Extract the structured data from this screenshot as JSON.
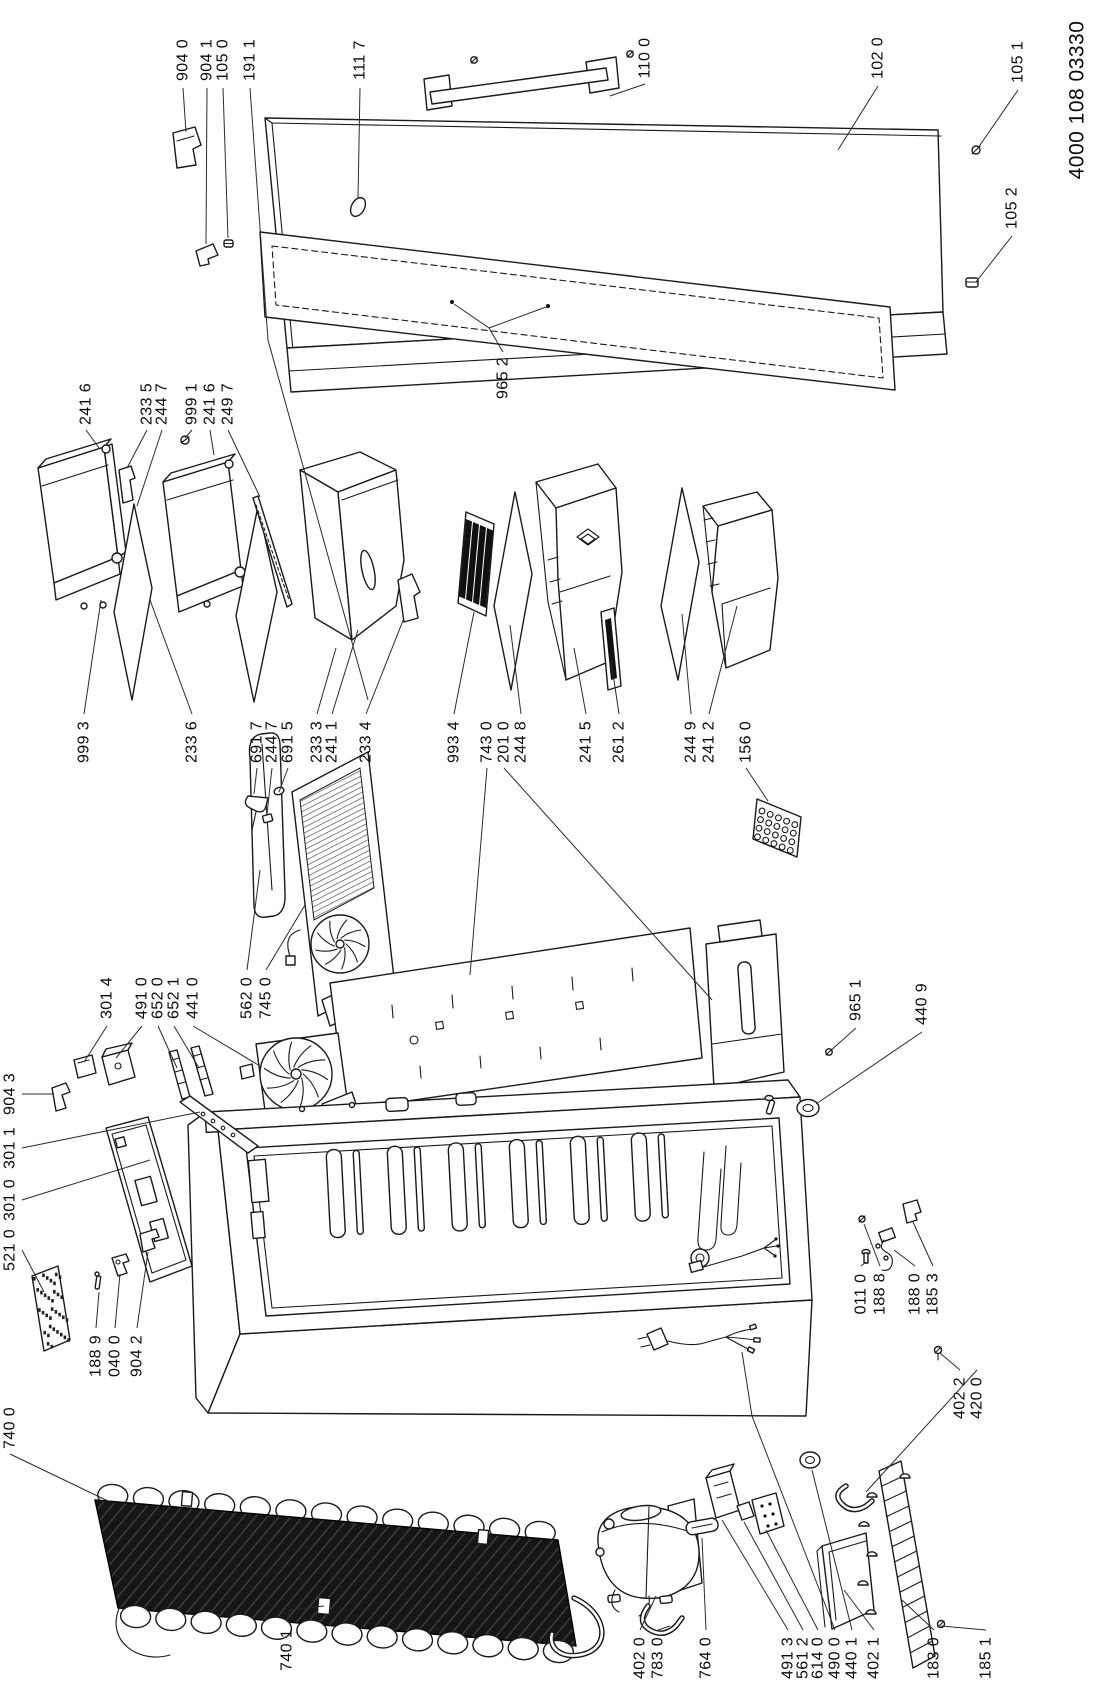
{
  "document": {
    "number": "4000 108 03330"
  },
  "parts": [
    {
      "label": "904 0",
      "pos": [
        183,
        60
      ],
      "leaders": [
        [
          [
            183,
            88
          ],
          [
            186,
            132
          ]
        ]
      ]
    },
    {
      "label": "904 1",
      "pos": [
        207,
        60
      ],
      "leaders": [
        [
          [
            207,
            88
          ],
          [
            206,
            244
          ]
        ]
      ]
    },
    {
      "label": "105 0",
      "pos": [
        223,
        60
      ],
      "leaders": [
        [
          [
            223,
            88
          ],
          [
            228,
            238
          ]
        ]
      ]
    },
    {
      "label": "191 1",
      "pos": [
        250,
        60
      ],
      "leaders": [
        [
          [
            250,
            88
          ],
          [
            268,
            340
          ],
          [
            368,
            700
          ]
        ]
      ]
    },
    {
      "label": "111 7",
      "pos": [
        360,
        60
      ],
      "leaders": [
        [
          [
            360,
            88
          ],
          [
            358,
            198
          ]
        ]
      ]
    },
    {
      "label": "110 0",
      "pos": [
        645,
        58
      ],
      "leaders": [
        [
          [
            645,
            84
          ],
          [
            610,
            96
          ]
        ]
      ]
    },
    {
      "label": "102 0",
      "pos": [
        878,
        58
      ],
      "leaders": [
        [
          [
            878,
            86
          ],
          [
            838,
            150
          ]
        ]
      ]
    },
    {
      "label": "105 1",
      "pos": [
        1018,
        62
      ],
      "leaders": [
        [
          [
            1018,
            90
          ],
          [
            978,
            148
          ]
        ]
      ]
    },
    {
      "label": "105 2",
      "pos": [
        1012,
        208
      ],
      "leaders": [
        [
          [
            1012,
            236
          ],
          [
            976,
            282
          ]
        ]
      ]
    },
    {
      "label": "965 2",
      "pos": [
        503,
        378
      ],
      "leaders": [
        [
          [
            503,
            352
          ],
          [
            489,
            328
          ],
          [
            454,
            304
          ]
        ],
        [
          [
            489,
            328
          ],
          [
            546,
            307
          ]
        ]
      ]
    },
    {
      "label": "241 6",
      "pos": [
        86,
        404
      ],
      "leaders": [
        [
          [
            86,
            430
          ],
          [
            99,
            448
          ]
        ]
      ]
    },
    {
      "label": "233 5",
      "pos": [
        147,
        404
      ],
      "leaders": [
        [
          [
            147,
            430
          ],
          [
            127,
            468
          ]
        ]
      ]
    },
    {
      "label": "244 7",
      "pos": [
        162,
        404
      ],
      "leaders": [
        [
          [
            162,
            430
          ],
          [
            137,
            506
          ]
        ]
      ]
    },
    {
      "label": "999 1",
      "pos": [
        192,
        404
      ],
      "leaders": [
        [
          [
            192,
            430
          ],
          [
            185,
            438
          ]
        ]
      ]
    },
    {
      "label": "241 6",
      "pos": [
        210,
        404
      ],
      "leaders": [
        [
          [
            210,
            430
          ],
          [
            214,
            455
          ]
        ]
      ]
    },
    {
      "label": "249 7",
      "pos": [
        228,
        404
      ],
      "leaders": [
        [
          [
            228,
            430
          ],
          [
            260,
            497
          ]
        ]
      ]
    },
    {
      "label": "999 3",
      "pos": [
        84,
        742
      ],
      "leaders": [
        [
          [
            84,
            714
          ],
          [
            101,
            600
          ]
        ]
      ]
    },
    {
      "label": "233 6",
      "pos": [
        192,
        742
      ],
      "leaders": [
        [
          [
            192,
            714
          ],
          [
            150,
            600
          ]
        ]
      ]
    },
    {
      "label": "691 7",
      "pos": [
        257,
        742
      ],
      "leaders": [
        [
          [
            257,
            768
          ],
          [
            254,
            794
          ]
        ]
      ]
    },
    {
      "label": "244 7",
      "pos": [
        272,
        742
      ],
      "leaders": [
        [
          [
            272,
            768
          ],
          [
            267,
            814
          ]
        ]
      ]
    },
    {
      "label": "691 5",
      "pos": [
        288,
        742
      ],
      "leaders": [
        [
          [
            288,
            768
          ],
          [
            279,
            792
          ]
        ]
      ]
    },
    {
      "label": "233 3",
      "pos": [
        317,
        742
      ],
      "leaders": [
        [
          [
            317,
            714
          ],
          [
            336,
            648
          ]
        ]
      ]
    },
    {
      "label": "241 1",
      "pos": [
        332,
        742
      ],
      "leaders": [
        [
          [
            332,
            714
          ],
          [
            358,
            630
          ]
        ]
      ]
    },
    {
      "label": "233 4",
      "pos": [
        366,
        742
      ],
      "leaders": [
        [
          [
            366,
            714
          ],
          [
            404,
            618
          ]
        ]
      ]
    },
    {
      "label": "993 4",
      "pos": [
        454,
        742
      ],
      "leaders": [
        [
          [
            454,
            714
          ],
          [
            474,
            612
          ]
        ]
      ]
    },
    {
      "label": "743 0",
      "pos": [
        487,
        742
      ],
      "leaders": [
        [
          [
            487,
            768
          ],
          [
            470,
            975
          ]
        ]
      ]
    },
    {
      "label": "201 0",
      "pos": [
        504,
        742
      ],
      "leaders": [
        [
          [
            504,
            768
          ],
          [
            712,
            1000
          ]
        ]
      ]
    },
    {
      "label": "244 8",
      "pos": [
        521,
        742
      ],
      "leaders": [
        [
          [
            521,
            714
          ],
          [
            510,
            625
          ]
        ]
      ]
    },
    {
      "label": "241 5",
      "pos": [
        586,
        742
      ],
      "leaders": [
        [
          [
            586,
            714
          ],
          [
            574,
            648
          ]
        ]
      ]
    },
    {
      "label": "261 2",
      "pos": [
        619,
        742
      ],
      "leaders": [
        [
          [
            619,
            714
          ],
          [
            611,
            660
          ]
        ]
      ]
    },
    {
      "label": "244 9",
      "pos": [
        691,
        742
      ],
      "leaders": [
        [
          [
            691,
            714
          ],
          [
            682,
            614
          ]
        ]
      ]
    },
    {
      "label": "241 2",
      "pos": [
        709,
        742
      ],
      "leaders": [
        [
          [
            709,
            714
          ],
          [
            737,
            606
          ]
        ]
      ]
    },
    {
      "label": "156 0",
      "pos": [
        746,
        742
      ],
      "leaders": [
        [
          [
            746,
            768
          ],
          [
            768,
            801
          ]
        ]
      ]
    },
    {
      "label": "562 0",
      "pos": [
        247,
        998
      ],
      "leaders": [
        [
          [
            247,
            970
          ],
          [
            260,
            870
          ]
        ]
      ]
    },
    {
      "label": "745 0",
      "pos": [
        266,
        998
      ],
      "leaders": [
        [
          [
            266,
            970
          ],
          [
            305,
            905
          ]
        ]
      ]
    },
    {
      "label": "301 4",
      "pos": [
        107,
        998
      ],
      "leaders": [
        [
          [
            107,
            1026
          ],
          [
            84,
            1062
          ]
        ]
      ]
    },
    {
      "label": "491 0",
      "pos": [
        142,
        998
      ],
      "leaders": [
        [
          [
            142,
            1026
          ],
          [
            116,
            1058
          ]
        ]
      ]
    },
    {
      "label": "652 0",
      "pos": [
        158,
        998
      ],
      "leaders": [
        [
          [
            158,
            1026
          ],
          [
            177,
            1068
          ]
        ]
      ]
    },
    {
      "label": "652 1",
      "pos": [
        174,
        998
      ],
      "leaders": [
        [
          [
            174,
            1026
          ],
          [
            199,
            1068
          ]
        ]
      ]
    },
    {
      "label": "441 0",
      "pos": [
        193,
        998
      ],
      "leaders": [
        [
          [
            193,
            1026
          ],
          [
            260,
            1066
          ]
        ]
      ]
    },
    {
      "label": "965 1",
      "pos": [
        856,
        1000
      ],
      "leaders": [
        [
          [
            856,
            1028
          ],
          [
            829,
            1052
          ]
        ]
      ]
    },
    {
      "label": "440 9",
      "pos": [
        922,
        1004
      ],
      "leaders": [
        [
          [
            922,
            1032
          ],
          [
            816,
            1104
          ]
        ]
      ]
    },
    {
      "label": "904 3",
      "pos": [
        10,
        1094
      ],
      "leaders": [
        [
          [
            22,
            1094
          ],
          [
            54,
            1094
          ]
        ]
      ]
    },
    {
      "label": "301 1",
      "pos": [
        10,
        1148
      ],
      "leaders": [
        [
          [
            22,
            1148
          ],
          [
            200,
            1112
          ]
        ]
      ]
    },
    {
      "label": "301 0",
      "pos": [
        10,
        1200
      ],
      "leaders": [
        [
          [
            22,
            1200
          ],
          [
            150,
            1160
          ]
        ]
      ]
    },
    {
      "label": "521 0",
      "pos": [
        10,
        1250
      ],
      "leaders": [
        [
          [
            22,
            1250
          ],
          [
            44,
            1292
          ]
        ]
      ]
    },
    {
      "label": "188 9",
      "pos": [
        96,
        1356
      ],
      "leaders": [
        [
          [
            96,
            1328
          ],
          [
            99,
            1292
          ]
        ]
      ]
    },
    {
      "label": "040 0",
      "pos": [
        115,
        1356
      ],
      "leaders": [
        [
          [
            115,
            1328
          ],
          [
            120,
            1274
          ]
        ]
      ]
    },
    {
      "label": "904 2",
      "pos": [
        137,
        1356
      ],
      "leaders": [
        [
          [
            137,
            1328
          ],
          [
            148,
            1252
          ]
        ]
      ]
    },
    {
      "label": "011 0",
      "pos": [
        861,
        1294
      ],
      "leaders": [
        [
          [
            861,
            1266
          ],
          [
            866,
            1262
          ]
        ]
      ]
    },
    {
      "label": "188 8",
      "pos": [
        880,
        1294
      ],
      "leaders": [
        [
          [
            880,
            1266
          ],
          [
            864,
            1224
          ]
        ]
      ]
    },
    {
      "label": "188 0",
      "pos": [
        915,
        1294
      ],
      "leaders": [
        [
          [
            915,
            1266
          ],
          [
            894,
            1250
          ]
        ]
      ]
    },
    {
      "label": "185 3",
      "pos": [
        933,
        1294
      ],
      "leaders": [
        [
          [
            933,
            1266
          ],
          [
            913,
            1222
          ]
        ]
      ]
    },
    {
      "label": "402 2",
      "pos": [
        960,
        1398
      ],
      "leaders": [
        [
          [
            960,
            1370
          ],
          [
            940,
            1353
          ]
        ]
      ]
    },
    {
      "label": "420 0",
      "pos": [
        977,
        1398
      ],
      "leaders": [
        [
          [
            977,
            1370
          ],
          [
            866,
            1492
          ]
        ]
      ]
    },
    {
      "label": "740 0",
      "pos": [
        10,
        1428
      ],
      "leaders": [
        [
          [
            10,
            1454
          ],
          [
            110,
            1502
          ]
        ]
      ]
    },
    {
      "label": "740 1",
      "pos": [
        287,
        1650
      ],
      "leaders": [
        [
          [
            287,
            1622
          ],
          [
            290,
            1610
          ],
          [
            324,
            1606
          ]
        ]
      ]
    },
    {
      "label": "402 0",
      "pos": [
        640,
        1658
      ],
      "leaders": [
        [
          [
            640,
            1630
          ],
          [
            656,
            1596
          ]
        ]
      ]
    },
    {
      "label": "783 0",
      "pos": [
        658,
        1658
      ],
      "leaders": [
        [
          [
            658,
            1630
          ],
          [
            670,
            1626
          ]
        ]
      ]
    },
    {
      "label": "764 0",
      "pos": [
        706,
        1658
      ],
      "leaders": [
        [
          [
            706,
            1630
          ],
          [
            702,
            1538
          ]
        ]
      ]
    },
    {
      "label": "491 3",
      "pos": [
        788,
        1658
      ],
      "leaders": [
        [
          [
            788,
            1630
          ],
          [
            722,
            1520
          ]
        ]
      ]
    },
    {
      "label": "561 2",
      "pos": [
        803,
        1658
      ],
      "leaders": [
        [
          [
            803,
            1630
          ],
          [
            744,
            1522
          ]
        ]
      ]
    },
    {
      "label": "614 0",
      "pos": [
        818,
        1658
      ],
      "leaders": [
        [
          [
            818,
            1630
          ],
          [
            766,
            1530
          ]
        ]
      ]
    },
    {
      "label": "490 0",
      "pos": [
        835,
        1658
      ],
      "leaders": [
        [
          [
            835,
            1630
          ],
          [
            752,
            1416
          ],
          [
            742,
            1352
          ]
        ]
      ]
    },
    {
      "label": "440 1",
      "pos": [
        852,
        1658
      ],
      "leaders": [
        [
          [
            852,
            1630
          ],
          [
            812,
            1470
          ]
        ]
      ]
    },
    {
      "label": "402 1",
      "pos": [
        874,
        1658
      ],
      "leaders": [
        [
          [
            874,
            1630
          ],
          [
            844,
            1590
          ]
        ]
      ]
    },
    {
      "label": "183 0",
      "pos": [
        934,
        1658
      ],
      "leaders": [
        [
          [
            934,
            1630
          ],
          [
            902,
            1600
          ]
        ]
      ]
    },
    {
      "label": "185 1",
      "pos": [
        986,
        1658
      ],
      "leaders": [
        [
          [
            986,
            1630
          ],
          [
            941,
            1626
          ]
        ]
      ]
    }
  ]
}
